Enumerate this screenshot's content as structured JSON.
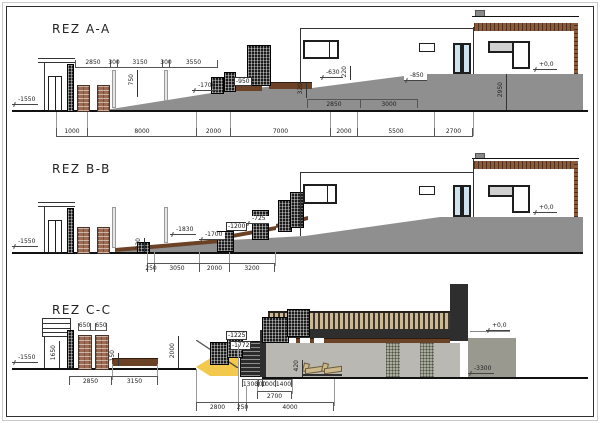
{
  "colors": {
    "terrain": "#8f8f8f",
    "brick": "#9c6b52",
    "gabion": "#1b1b1b",
    "deck_wood": "#6b4226",
    "roof_wood": "#8a5a3a",
    "glass": "#cfe3ee",
    "earth_wedge": "#f2c94c",
    "slab": "#2e2e2e",
    "interior": "#b9b8b2"
  },
  "sections": [
    {
      "id": "A-A",
      "title": "REZ A-A",
      "dims_top": [
        "2850",
        "300",
        "3150",
        "300",
        "3550"
      ],
      "dims_mid": [
        "2850",
        "3000"
      ],
      "dims_bottom": [
        "1000",
        "8000",
        "2000",
        "7000",
        "2000",
        "5500",
        "2700"
      ],
      "vdims": {
        "v750": "750",
        "v320": "320",
        "v220": "220",
        "v2950": "2950"
      },
      "levels": {
        "left": "-1550",
        "slope": "-1700",
        "box950": "-950",
        "l630": "-630",
        "l850": "-850",
        "zero": "+0,0"
      }
    },
    {
      "id": "B-B",
      "title": "REZ B-B",
      "dims_bottom": [
        "250",
        "3050",
        "2000",
        "3200"
      ],
      "vdims": {
        "v230": "230"
      },
      "levels": {
        "left": "-1550",
        "l1830": "-1830",
        "l1700": "-1700",
        "box1200": "-1200",
        "l725": "-725",
        "zero": "+0,0"
      }
    },
    {
      "id": "C-C",
      "title": "REZ C-C",
      "dims_piers": [
        "650",
        "",
        "650"
      ],
      "dims_left_bottom": [
        "2850",
        "3150"
      ],
      "dims_stairs_row1": [
        "1300",
        "300",
        "1000",
        "1400"
      ],
      "dims_stairs_row2": [
        "2700"
      ],
      "dims_stairs_row3": [
        "2800",
        "250",
        "4000"
      ],
      "vdims": {
        "v1650": "1650",
        "v150": "150",
        "v2000": "2000",
        "v420": "420"
      },
      "levels": {
        "left": "-1550",
        "box1225": "-1225",
        "box1772": "-1772",
        "zero": "+0,0",
        "l3300": "-3300"
      }
    }
  ]
}
